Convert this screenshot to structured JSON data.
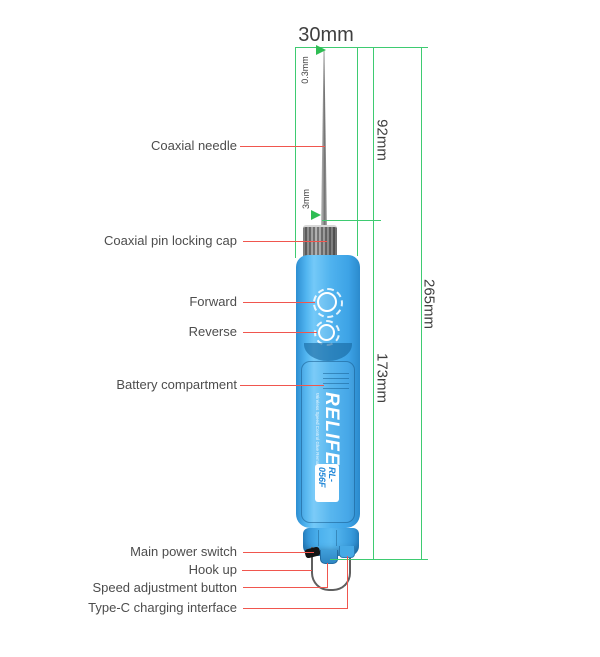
{
  "part_labels": [
    {
      "text": "Coaxial needle"
    },
    {
      "text": "Coaxial pin locking cap"
    },
    {
      "text": "Forward"
    },
    {
      "text": "Reverse"
    },
    {
      "text": "Battery compartment"
    },
    {
      "text": "Main power switch"
    },
    {
      "text": "Hook up"
    },
    {
      "text": "Speed adjustment button"
    },
    {
      "text": "Type-C charging interface"
    }
  ],
  "dimensions": {
    "body_width": "30mm",
    "tip_diameter": "0.3mm",
    "needle_diameter": "3mm",
    "upper_section_length": "92mm",
    "handle_length": "173mm",
    "total_length": "265mm"
  },
  "device": {
    "brand": "RELIFE",
    "model": "RL-056F",
    "tagline": "Wireless Speed Control Glue Removal Pen"
  },
  "colors": {
    "dimension_green": "#3ecb71",
    "leader_red": "#f0564e",
    "body_blue": "#4fb2ee"
  }
}
